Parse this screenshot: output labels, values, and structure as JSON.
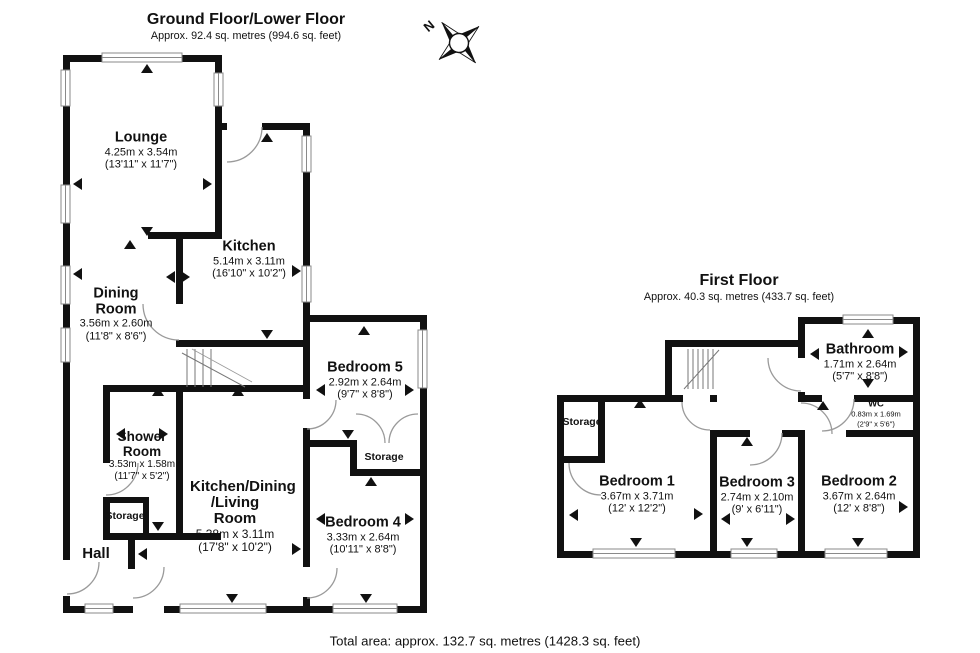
{
  "compass": {
    "north_label": "N"
  },
  "ground_floor": {
    "title": "Ground Floor/Lower Floor",
    "subtitle": "Approx. 92.4 sq. metres (994.6 sq. feet)",
    "rooms": {
      "lounge": {
        "name": "Lounge",
        "metric": "4.25m x 3.54m",
        "imperial": "(13'11\" x 11'7\")"
      },
      "kitchen": {
        "name": "Kitchen",
        "metric": "5.14m x 3.11m",
        "imperial": "(16'10\" x 10'2\")"
      },
      "dining": {
        "name": "Dining Room",
        "metric": "3.56m x 2.60m",
        "imperial": "(11'8\" x 8'6\")"
      },
      "shower": {
        "name": "Shower Room",
        "metric": "3.53m x 1.58m",
        "imperial": "(11'7\" x 5'2\")"
      },
      "kdl": {
        "name": "Kitchen/Dining /Living Room",
        "metric": "5.38m x 3.11m",
        "imperial": "(17'8\" x 10'2\")"
      },
      "bedroom5": {
        "name": "Bedroom 5",
        "metric": "2.92m x 2.64m",
        "imperial": "(9'7\" x 8'8\")"
      },
      "bedroom4": {
        "name": "Bedroom 4",
        "metric": "3.33m x 2.64m",
        "imperial": "(10'11\" x 8'8\")"
      },
      "hall": {
        "name": "Hall"
      },
      "storage_inner": {
        "name": "Storage"
      },
      "storage_wing": {
        "name": "Storage"
      }
    }
  },
  "first_floor": {
    "title": "First Floor",
    "subtitle": "Approx. 40.3 sq. metres (433.7 sq. feet)",
    "rooms": {
      "bathroom": {
        "name": "Bathroom",
        "metric": "1.71m x 2.64m",
        "imperial": "(5'7\" x 8'8\")"
      },
      "wc": {
        "name": "WC",
        "metric": "0.83m x 1.69m",
        "imperial": "(2'9\" x 5'6\")"
      },
      "storage": {
        "name": "Storage"
      },
      "bedroom1": {
        "name": "Bedroom 1",
        "metric": "3.67m x 3.71m",
        "imperial": "(12' x 12'2\")"
      },
      "bedroom3": {
        "name": "Bedroom 3",
        "metric": "2.74m x 2.10m",
        "imperial": "(9' x 6'11\")"
      },
      "bedroom2": {
        "name": "Bedroom 2",
        "metric": "3.67m x 2.64m",
        "imperial": "(12' x 8'8\")"
      }
    }
  },
  "footer": {
    "total_area": "Total area: approx. 132.7 sq. metres (1428.3 sq. feet)"
  }
}
